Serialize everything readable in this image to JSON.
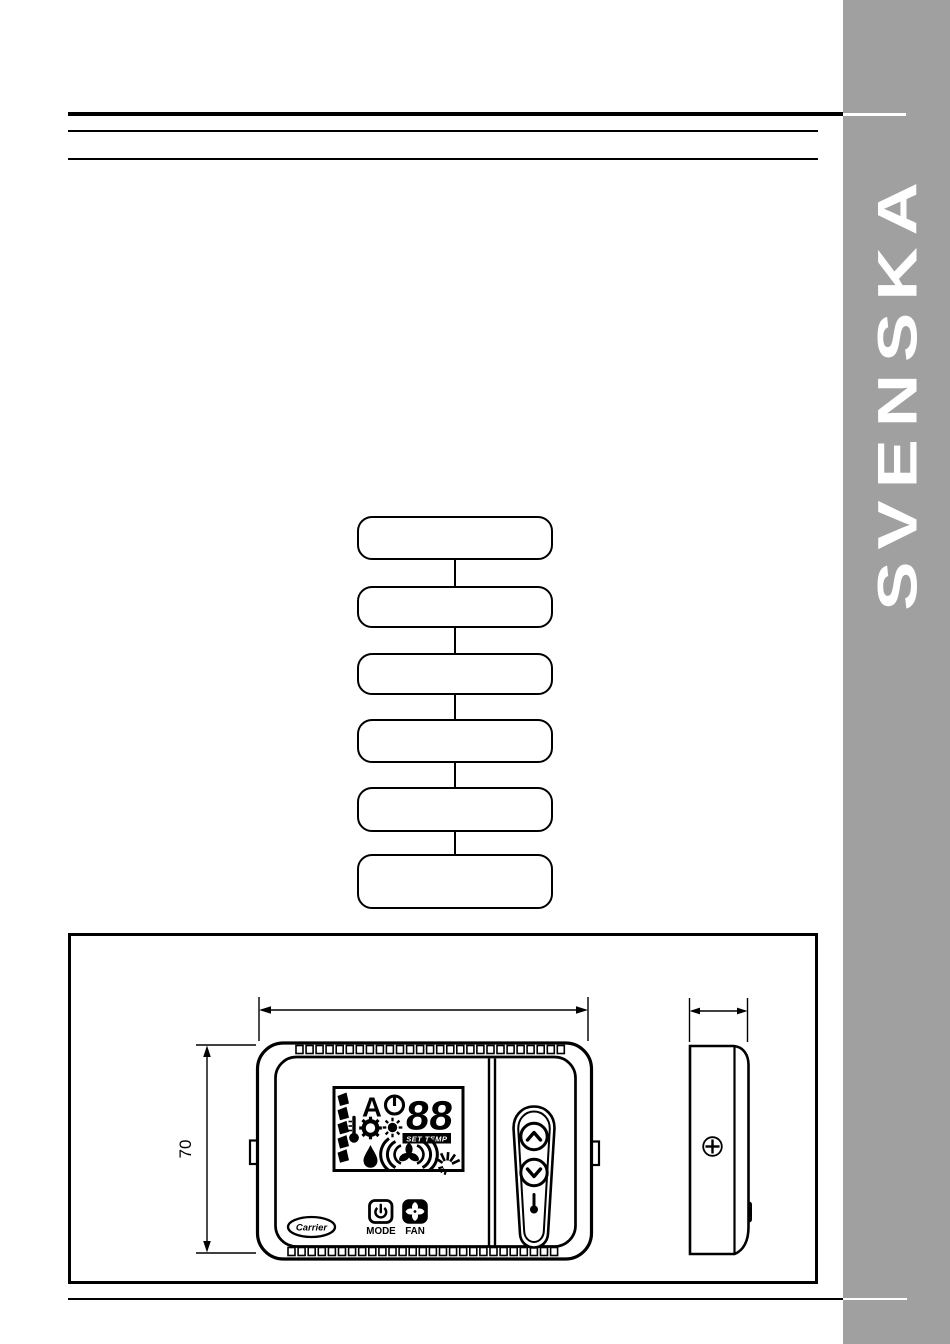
{
  "page": {
    "background": "#ffffff",
    "ink": "#000000"
  },
  "sidebar": {
    "label": "SVENSKA",
    "background": "#a0a0a0",
    "text_color": "#ffffff"
  },
  "flowchart": {
    "boxes": [
      {
        "label": ""
      },
      {
        "label": ""
      },
      {
        "label": ""
      },
      {
        "label": ""
      },
      {
        "label": ""
      },
      {
        "label": ""
      }
    ]
  },
  "figure": {
    "height_dimension_label": "70",
    "front_view": {
      "brand_label": "Carrier",
      "top_vent_slots": 27,
      "bottom_vent_slots": 27,
      "lcd": {
        "digits": "88",
        "set_temp_label": "SET TEMP",
        "auto_indicator": "A",
        "icons": [
          "fan-speed-segments",
          "auto-indicator",
          "power-icon",
          "seven-segment-digits",
          "set-temp-badge",
          "thermometer-icon",
          "cool-icon",
          "heat-icon",
          "humidity-icon",
          "fan-waves-icon",
          "ir-signal-icon"
        ]
      },
      "buttons": {
        "mode_label": "MODE",
        "fan_label": "FAN",
        "icons": [
          "power-icon",
          "fan-icon",
          "temp-up-button",
          "temp-down-button",
          "thermometer-icon"
        ]
      }
    },
    "side_view": {
      "icons": [
        "screw-icon"
      ]
    }
  }
}
